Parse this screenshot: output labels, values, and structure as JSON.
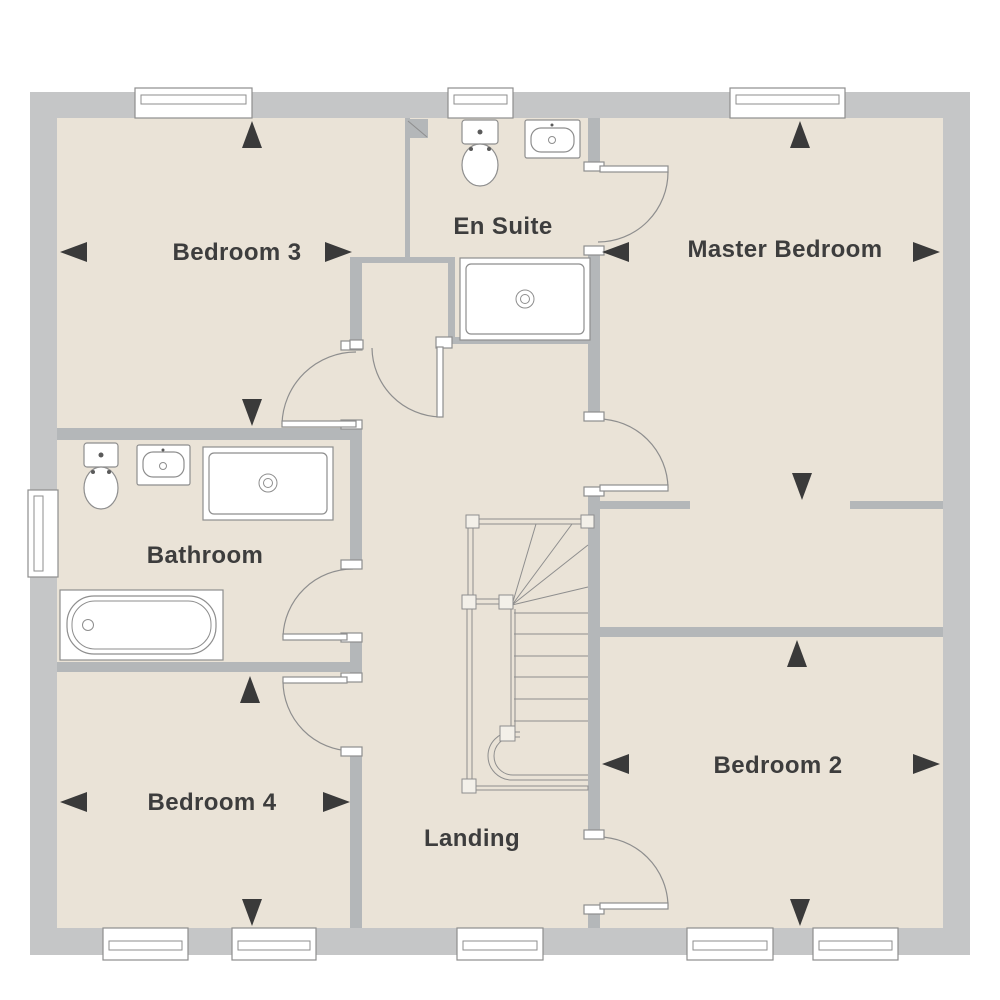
{
  "rooms": {
    "bedroom3": {
      "label": "Bedroom 3"
    },
    "en_suite": {
      "label": "En Suite"
    },
    "master_bedroom": {
      "label": "Master Bedroom"
    },
    "bathroom": {
      "label": "Bathroom"
    },
    "bedroom4": {
      "label": "Bedroom 4"
    },
    "bedroom2": {
      "label": "Bedroom 2"
    },
    "landing": {
      "label": "Landing"
    }
  },
  "fixtures": {
    "en_suite": [
      "toilet",
      "basin",
      "shower"
    ],
    "bathroom": [
      "toilet",
      "basin",
      "shower",
      "bathtub"
    ],
    "stairwell": [
      "staircase-with-winders"
    ]
  },
  "dimension_arrows": {
    "bedroom3": [
      "up",
      "down",
      "left",
      "right"
    ],
    "master_bedroom": [
      "up",
      "down",
      "left",
      "right"
    ],
    "bedroom2": [
      "up",
      "down",
      "left",
      "right"
    ],
    "bedroom4": [
      "up",
      "down",
      "left",
      "right"
    ]
  },
  "windows": {
    "top": 3,
    "bottom": 5,
    "left": 1
  },
  "colors": {
    "wall_outer": "#c5c6c7",
    "wall_inner": "#b4b7b9",
    "floor": "#eae3d7",
    "line": "#8e8e8e",
    "fixture_fill": "#ffffff",
    "arrow": "#3a3a3a",
    "text": "#3d3d3d",
    "background": "#ffffff"
  }
}
